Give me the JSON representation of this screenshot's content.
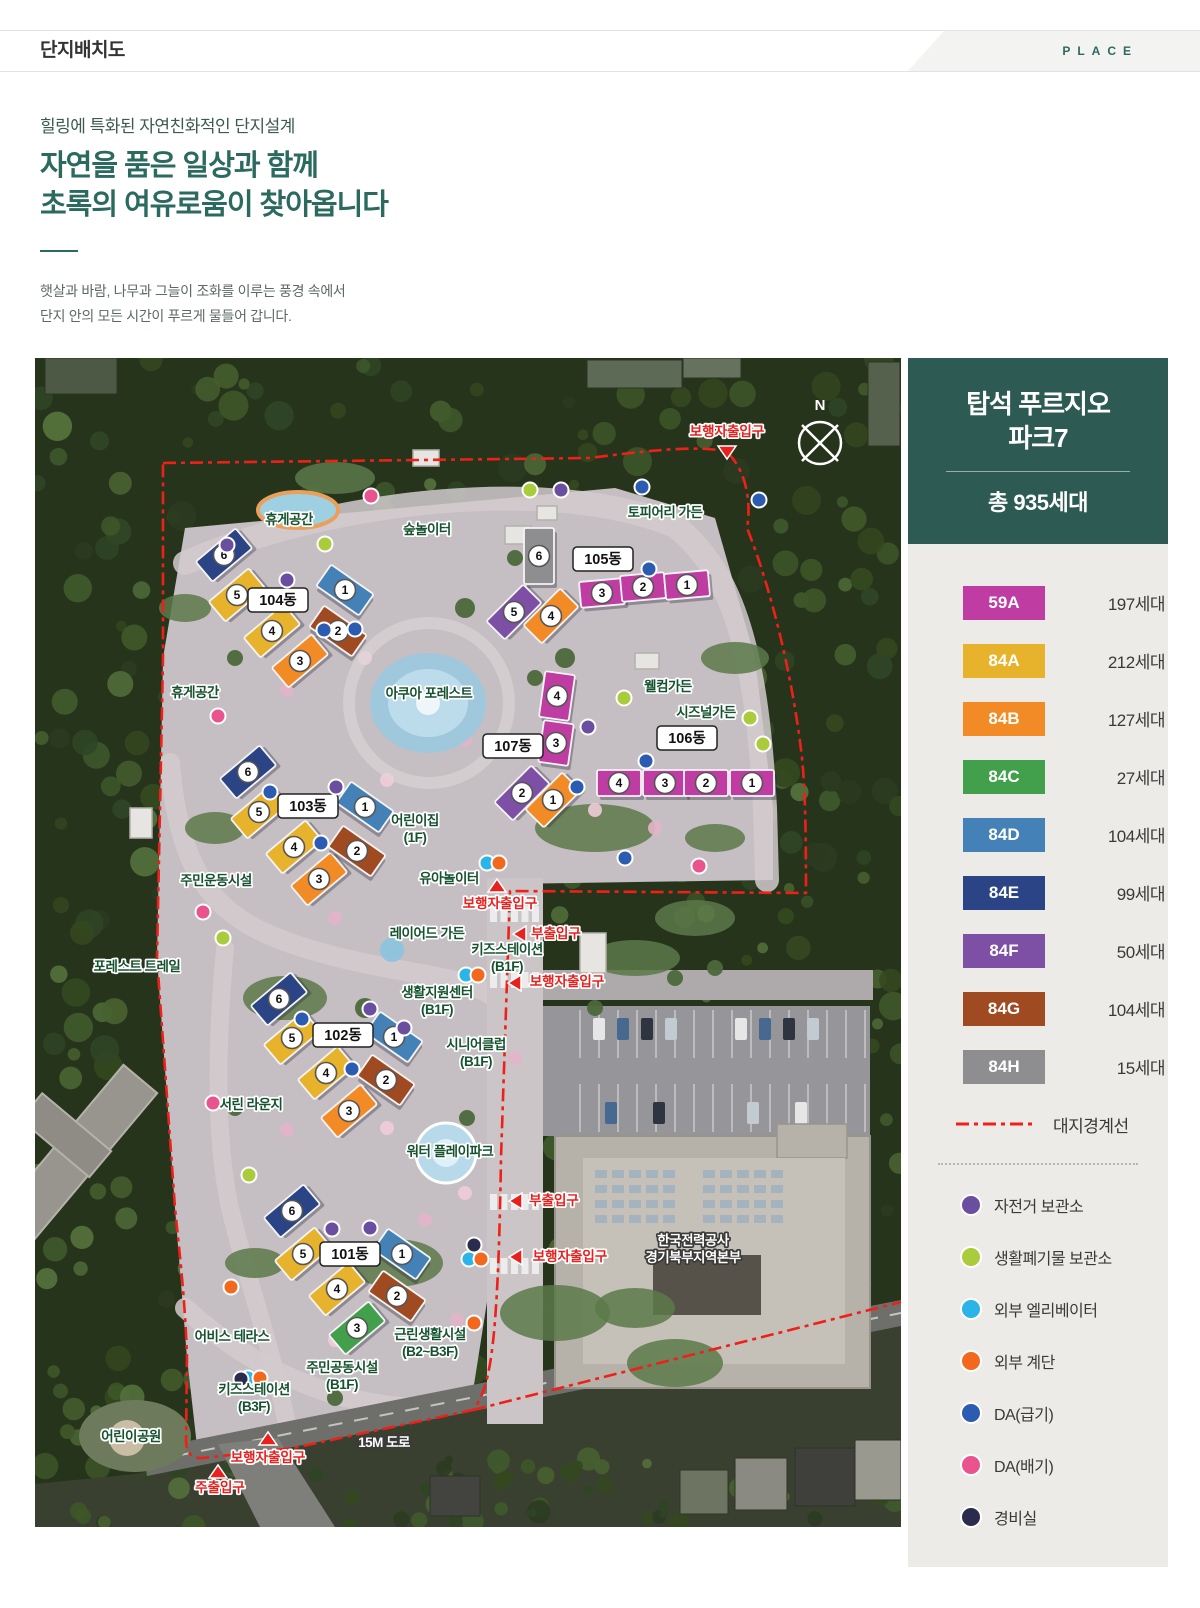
{
  "header": {
    "title": "단지배치도",
    "tag": "PLACE"
  },
  "intro": {
    "eyebrow": "힐링에 특화된 자연친화적인 단지설계",
    "heading_line1": "자연을 품은 일상과 함께",
    "heading_line2": "초록의 여유로움이 찾아옵니다",
    "body_line1": "햇살과 바람, 나무과 그늘이 조화를 이루는 풍경 속에서",
    "body_line2": "단지 안의 모든 시간이 푸르게 물들어 갑니다."
  },
  "panel": {
    "title_line1": "탑석 푸르지오",
    "title_line2": "파크7",
    "total": "총 935세대",
    "unit_types": [
      {
        "code": "59A",
        "count": "197세대",
        "color": "#bf3ca2"
      },
      {
        "code": "84A",
        "count": "212세대",
        "color": "#e7b32c"
      },
      {
        "code": "84B",
        "count": "127세대",
        "color": "#f28b25"
      },
      {
        "code": "84C",
        "count": "27세대",
        "color": "#42a04c"
      },
      {
        "code": "84D",
        "count": "104세대",
        "color": "#4381b6"
      },
      {
        "code": "84E",
        "count": "99세대",
        "color": "#2a4485"
      },
      {
        "code": "84F",
        "count": "50세대",
        "color": "#7d4fa5"
      },
      {
        "code": "84G",
        "count": "104세대",
        "color": "#a04a21"
      },
      {
        "code": "84H",
        "count": "15세대",
        "color": "#8e8e90"
      }
    ],
    "boundary": {
      "label": "대지경계선",
      "color": "#ee2018"
    },
    "facilities": [
      {
        "key": "bike",
        "label": "자전거 보관소",
        "color": "#6a4ea0"
      },
      {
        "key": "waste",
        "label": "생활폐기물 보관소",
        "color": "#a9cb3c"
      },
      {
        "key": "elevator",
        "label": "외부 엘리베이터",
        "color": "#2ab4e8"
      },
      {
        "key": "stairs",
        "label": "외부 계단",
        "color": "#f2691d"
      },
      {
        "key": "da_supply",
        "label": "DA(급기)",
        "color": "#2b5cb2"
      },
      {
        "key": "da_exhaust",
        "label": "DA(배기)",
        "color": "#e9548e"
      },
      {
        "key": "guard",
        "label": "경비실",
        "color": "#2b2b4d"
      }
    ]
  },
  "map": {
    "compass_label": "N",
    "buildings": [
      {
        "name": "104동",
        "label": [
          243,
          242
        ],
        "units": [
          [
            6,
            "84E",
            189,
            197,
            -40
          ],
          [
            5,
            "84A",
            202,
            237,
            -40
          ],
          [
            4,
            "84A",
            237,
            273,
            -40
          ],
          [
            3,
            "84B",
            265,
            303,
            -40
          ],
          [
            1,
            "84D",
            310,
            232,
            35
          ],
          [
            2,
            "84G",
            303,
            273,
            35
          ]
        ]
      },
      {
        "name": "105동",
        "label": [
          568,
          201
        ],
        "units": [
          [
            6,
            "84H",
            504,
            198,
            0,
            30,
            56
          ],
          [
            5,
            "84F",
            479,
            254,
            -45
          ],
          [
            4,
            "84B",
            516,
            258,
            -45
          ],
          [
            3,
            "59A",
            567,
            235,
            -5,
            44,
            26
          ],
          [
            2,
            "59A",
            608,
            229,
            -5,
            44,
            26
          ],
          [
            1,
            "59A",
            652,
            227,
            -5,
            44,
            26
          ]
        ]
      },
      {
        "name": "106동",
        "label": [
          652,
          380
        ],
        "units": [
          [
            4,
            "59A",
            584,
            425,
            0,
            44,
            26
          ],
          [
            3,
            "59A",
            630,
            425,
            0,
            44,
            26
          ],
          [
            2,
            "59A",
            671,
            425,
            0,
            44,
            26
          ],
          [
            1,
            "59A",
            717,
            425,
            0,
            44,
            26
          ]
        ]
      },
      {
        "name": "107동",
        "label": [
          478,
          388
        ],
        "units": [
          [
            4,
            "59A",
            522,
            338,
            8,
            30,
            46
          ],
          [
            3,
            "59A",
            521,
            385,
            8,
            30,
            42
          ],
          [
            2,
            "84F",
            487,
            435,
            -45
          ],
          [
            1,
            "84B",
            518,
            442,
            -45
          ]
        ]
      },
      {
        "name": "103동",
        "label": [
          273,
          448
        ],
        "units": [
          [
            6,
            "84E",
            213,
            414,
            -40
          ],
          [
            5,
            "84A",
            224,
            454,
            -40
          ],
          [
            4,
            "84A",
            259,
            489,
            -40
          ],
          [
            3,
            "84B",
            284,
            521,
            -40
          ],
          [
            1,
            "84D",
            330,
            449,
            35
          ],
          [
            2,
            "84G",
            322,
            493,
            35
          ]
        ]
      },
      {
        "name": "102동",
        "label": [
          308,
          677
        ],
        "units": [
          [
            6,
            "84E",
            244,
            641,
            -40
          ],
          [
            5,
            "84A",
            257,
            680,
            -40
          ],
          [
            4,
            "84A",
            291,
            715,
            -40
          ],
          [
            3,
            "84B",
            314,
            753,
            -40
          ],
          [
            1,
            "84D",
            359,
            679,
            35
          ],
          [
            2,
            "84G",
            351,
            722,
            35
          ]
        ]
      },
      {
        "name": "101동",
        "label": [
          315,
          896
        ],
        "units": [
          [
            6,
            "84E",
            257,
            853,
            -40
          ],
          [
            5,
            "84A",
            268,
            896,
            -40
          ],
          [
            4,
            "84A",
            302,
            931,
            -40
          ],
          [
            3,
            "84C",
            322,
            970,
            -40
          ],
          [
            1,
            "84D",
            367,
            896,
            35
          ],
          [
            2,
            "84G",
            362,
            938,
            35
          ]
        ]
      }
    ],
    "amenities": [
      {
        "x": 254,
        "y": 166,
        "lines": [
          "휴게공간"
        ]
      },
      {
        "x": 392,
        "y": 176,
        "lines": [
          "숲놀이터"
        ]
      },
      {
        "x": 630,
        "y": 159,
        "lines": [
          "토피어리 가든"
        ]
      },
      {
        "x": 394,
        "y": 340,
        "lines": [
          "아쿠아 포레스트"
        ]
      },
      {
        "x": 633,
        "y": 333,
        "lines": [
          "웰컴가든"
        ]
      },
      {
        "x": 671,
        "y": 359,
        "lines": [
          "시즈널가든"
        ]
      },
      {
        "x": 160,
        "y": 339,
        "lines": [
          "휴게공간"
        ]
      },
      {
        "x": 380,
        "y": 467,
        "lines": [
          "어린이집",
          "(1F)"
        ]
      },
      {
        "x": 181,
        "y": 527,
        "lines": [
          "주민운동시설"
        ]
      },
      {
        "x": 414,
        "y": 525,
        "lines": [
          "유아놀이터"
        ]
      },
      {
        "x": 392,
        "y": 580,
        "lines": [
          "레이어드 가든"
        ]
      },
      {
        "x": 472,
        "y": 596,
        "lines": [
          "키즈스테이션",
          "(B1F)"
        ]
      },
      {
        "x": 402,
        "y": 639,
        "lines": [
          "생활지원센터",
          "(B1F)"
        ]
      },
      {
        "x": 441,
        "y": 691,
        "lines": [
          "시니어클럽",
          "(B1F)"
        ]
      },
      {
        "x": 216,
        "y": 751,
        "lines": [
          "서린 라운지"
        ]
      },
      {
        "x": 415,
        "y": 798,
        "lines": [
          "워터 플레이파크"
        ]
      },
      {
        "x": 102,
        "y": 613,
        "lines": [
          "포레스트 트레일"
        ]
      },
      {
        "x": 197,
        "y": 983,
        "lines": [
          "어비스 테라스"
        ]
      },
      {
        "x": 395,
        "y": 981,
        "lines": [
          "근린생활시설",
          "(B2~B3F)"
        ]
      },
      {
        "x": 307,
        "y": 1014,
        "lines": [
          "주민공동시설",
          "(B1F)"
        ]
      },
      {
        "x": 219,
        "y": 1036,
        "lines": [
          "키즈스테이션",
          "(B3F)"
        ]
      },
      {
        "x": 96,
        "y": 1083,
        "lines": [
          "어린이공원"
        ]
      }
    ],
    "white_labels": [
      {
        "x": 349,
        "y": 1089,
        "lines": [
          "15M 도로"
        ]
      },
      {
        "x": 658,
        "y": 887,
        "lines": [
          "한국전력공사",
          "경기북부지역본부"
        ]
      }
    ],
    "entrances": [
      {
        "label": "보행자출입구",
        "x": 692,
        "y": 78,
        "dir": "down",
        "tx": 692,
        "ty": 95
      },
      {
        "label": "보행자출입구",
        "x": 465,
        "y": 550,
        "dir": "up",
        "tx": 462,
        "ty": 527
      },
      {
        "label": "부출입구",
        "x": 521,
        "y": 580,
        "dir": "left",
        "tx": 484,
        "ty": 576
      },
      {
        "label": "보행자출입구",
        "x": 532,
        "y": 628,
        "dir": "left",
        "tx": 479,
        "ty": 625
      },
      {
        "label": "부출입구",
        "x": 519,
        "y": 847,
        "dir": "left",
        "tx": 480,
        "ty": 843
      },
      {
        "label": "보행자출입구",
        "x": 535,
        "y": 903,
        "dir": "left",
        "tx": 480,
        "ty": 899
      },
      {
        "label": "보행자출입구",
        "x": 233,
        "y": 1104,
        "dir": "up",
        "tx": 233,
        "ty": 1080
      },
      {
        "label": "주출입구",
        "x": 185,
        "y": 1134,
        "dir": "up",
        "tx": 183,
        "ty": 1113
      }
    ],
    "dots": [
      {
        "key": "da_exhaust",
        "x": 336,
        "y": 138
      },
      {
        "key": "da_exhaust",
        "x": 183,
        "y": 358
      },
      {
        "key": "da_exhaust",
        "x": 168,
        "y": 554
      },
      {
        "key": "da_exhaust",
        "x": 178,
        "y": 745
      },
      {
        "key": "da_exhaust",
        "x": 664,
        "y": 508
      },
      {
        "key": "waste",
        "x": 495,
        "y": 132
      },
      {
        "key": "waste",
        "x": 290,
        "y": 186
      },
      {
        "key": "waste",
        "x": 715,
        "y": 360
      },
      {
        "key": "waste",
        "x": 728,
        "y": 386
      },
      {
        "key": "waste",
        "x": 589,
        "y": 340
      },
      {
        "key": "waste",
        "x": 214,
        "y": 817
      },
      {
        "key": "waste",
        "x": 188,
        "y": 580
      },
      {
        "key": "bike",
        "x": 526,
        "y": 132
      },
      {
        "key": "bike",
        "x": 192,
        "y": 187
      },
      {
        "key": "bike",
        "x": 252,
        "y": 222
      },
      {
        "key": "bike",
        "x": 553,
        "y": 369
      },
      {
        "key": "bike",
        "x": 301,
        "y": 429
      },
      {
        "key": "bike",
        "x": 335,
        "y": 651
      },
      {
        "key": "bike",
        "x": 369,
        "y": 670
      },
      {
        "key": "bike",
        "x": 297,
        "y": 871
      },
      {
        "key": "bike",
        "x": 335,
        "y": 870
      },
      {
        "key": "elevator",
        "x": 452,
        "y": 505
      },
      {
        "key": "elevator",
        "x": 431,
        "y": 617
      },
      {
        "key": "elevator",
        "x": 434,
        "y": 901
      },
      {
        "key": "elevator",
        "x": 213,
        "y": 1020
      },
      {
        "key": "stairs",
        "x": 464,
        "y": 505
      },
      {
        "key": "stairs",
        "x": 443,
        "y": 617
      },
      {
        "key": "stairs",
        "x": 446,
        "y": 901
      },
      {
        "key": "stairs",
        "x": 225,
        "y": 1020
      },
      {
        "key": "stairs",
        "x": 196,
        "y": 929
      },
      {
        "key": "stairs",
        "x": 439,
        "y": 965
      },
      {
        "key": "da_supply",
        "x": 607,
        "y": 129
      },
      {
        "key": "da_supply",
        "x": 289,
        "y": 272
      },
      {
        "key": "da_supply",
        "x": 320,
        "y": 271
      },
      {
        "key": "da_supply",
        "x": 614,
        "y": 211
      },
      {
        "key": "da_supply",
        "x": 724,
        "y": 142
      },
      {
        "key": "da_supply",
        "x": 611,
        "y": 403
      },
      {
        "key": "da_supply",
        "x": 542,
        "y": 429
      },
      {
        "key": "da_supply",
        "x": 590,
        "y": 500
      },
      {
        "key": "da_supply",
        "x": 235,
        "y": 434
      },
      {
        "key": "da_supply",
        "x": 286,
        "y": 485
      },
      {
        "key": "da_supply",
        "x": 317,
        "y": 711
      },
      {
        "key": "da_supply",
        "x": 267,
        "y": 661
      },
      {
        "key": "guard",
        "x": 439,
        "y": 887
      },
      {
        "key": "guard",
        "x": 206,
        "y": 1021
      }
    ]
  }
}
